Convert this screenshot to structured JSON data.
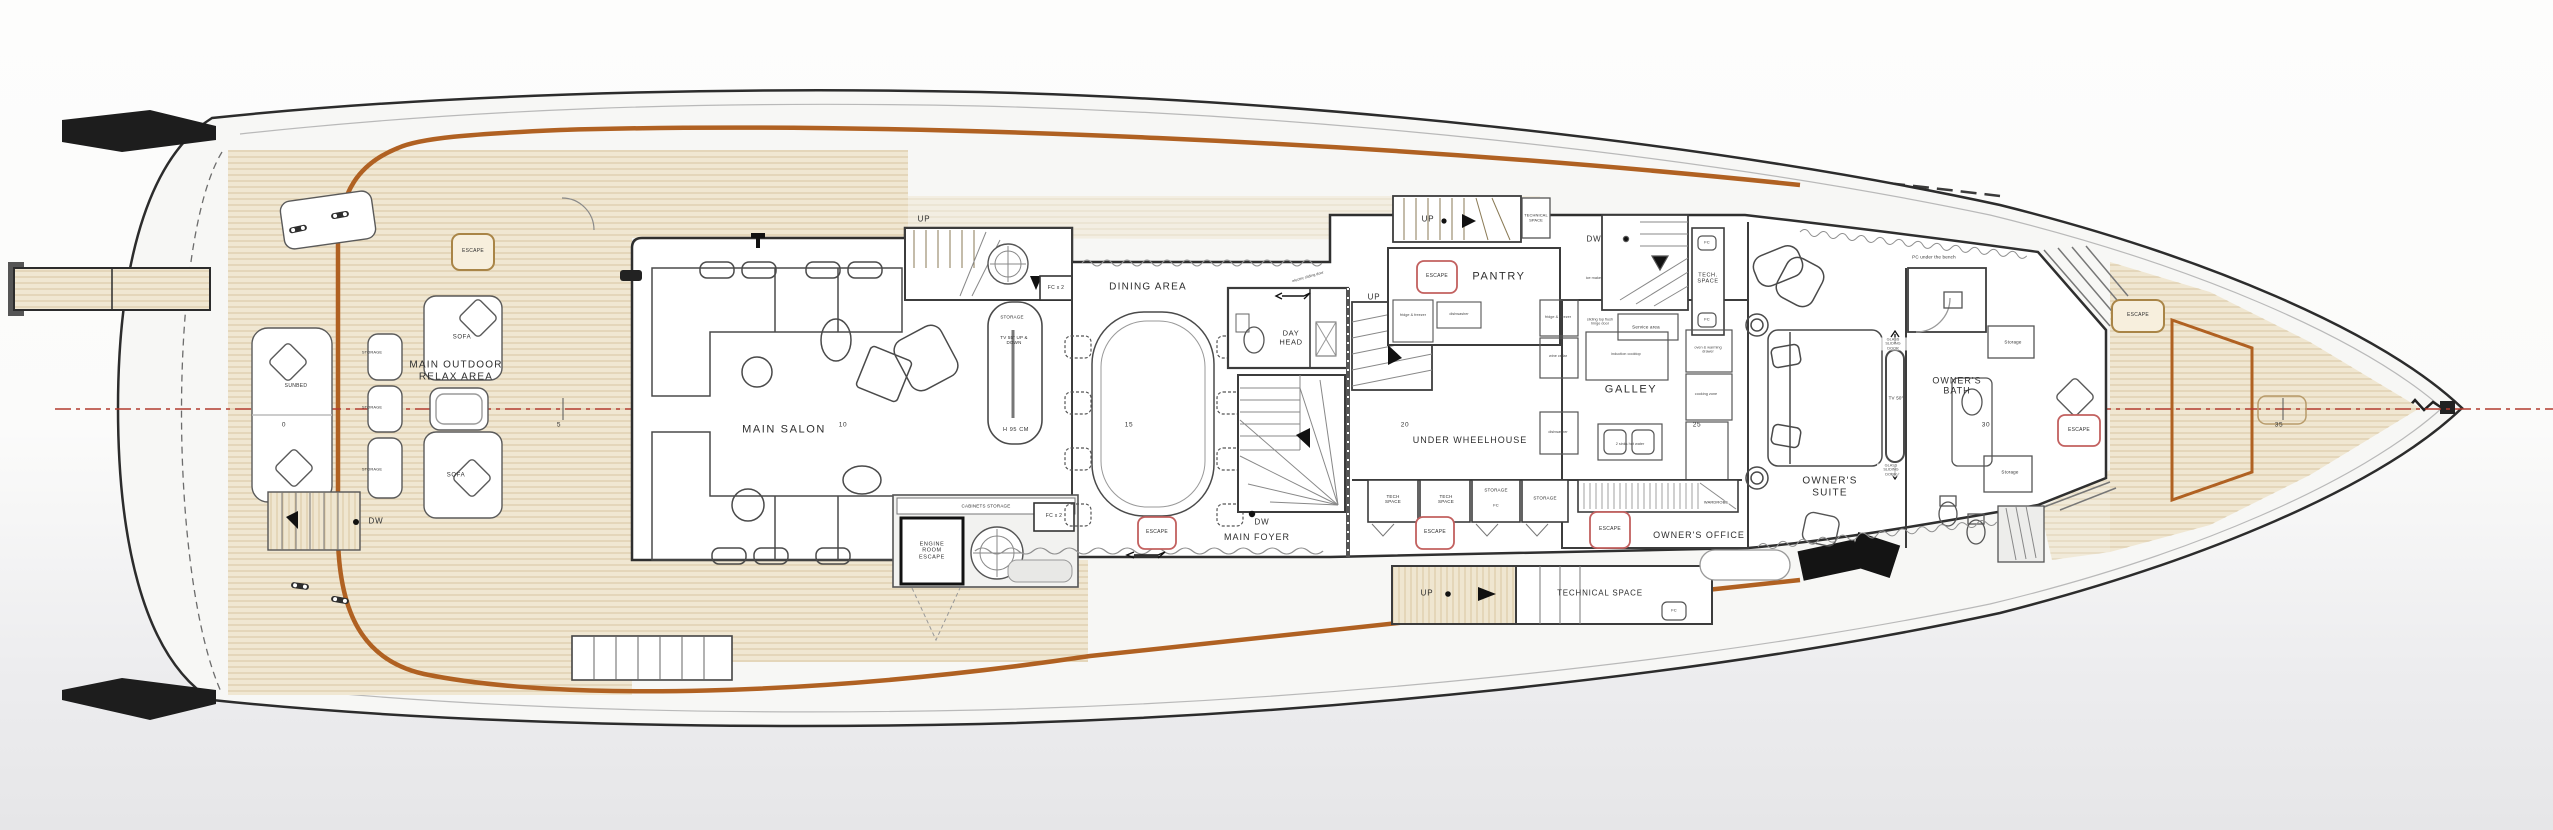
{
  "title": "Yacht main deck floor plan",
  "colors": {
    "teak": "#f0e7d2",
    "teak_line": "#d8c6a1",
    "caprail_orange": "#b06122",
    "centerline_red": "#b23b2e",
    "escape_red_outline": "#c2605f",
    "escape_tan_outline": "#a98547",
    "wall_dark": "#3f3f3f",
    "background_bottom": "#e6e6e8"
  },
  "rooms": {
    "main_outdoor_relax_area": "MAIN OUTDOOR RELAX AREA",
    "main_salon": "MAIN SALON",
    "dining_area": "DINING AREA",
    "day_head": "DAY HEAD",
    "main_foyer": "MAIN FOYER",
    "under_wheelhouse": "UNDER WHEELHOUSE",
    "pantry": "PANTRY",
    "galley": "GALLEY",
    "owners_suite": "OWNER'S SUITE",
    "owners_office": "OWNER'S OFFICE",
    "owners_bath": "OWNER'S BATH",
    "technical_space": "TECHNICAL SPACE",
    "tech_space": "TECH SPACE",
    "tech_space_dot": "TECH. SPACE"
  },
  "labels": {
    "escape": "ESCAPE",
    "up": "UP",
    "dw": "DW",
    "sofa": "SOFA",
    "sunbed": "SUNBED",
    "storage": "STORAGE",
    "storage_lc": "Storage",
    "fc": "FC",
    "fcx2": "FC x 2",
    "engine_room_escape": "ENGINE ROOM ESCAPE",
    "cabinets_storage": "CABINETS STORAGE",
    "wardrobe": "WARDROBE",
    "tv55": "TV 55\" UP & DOWN",
    "h95": "H 95 CM",
    "tv50": "TV 50\"",
    "pc_bench": "PC under the bench",
    "service_area": "Service area",
    "electric_sliding_door": "electric sliding door",
    "glass_sliding_door": "GLASS SLIDING DOOR"
  },
  "stations": [
    "0",
    "5",
    "10",
    "15",
    "20",
    "25",
    "30",
    "35"
  ],
  "notes": {
    "n1": "fridge & freezer",
    "n2": "dishwasher",
    "n3": "ice maker",
    "n4": "sliding top flush hinge door",
    "n5": "induction cooktop",
    "n6": "oven & warming drawer",
    "n7": "wine cellar",
    "n8": "2 sinks hot water",
    "n9": "cooking zone"
  }
}
